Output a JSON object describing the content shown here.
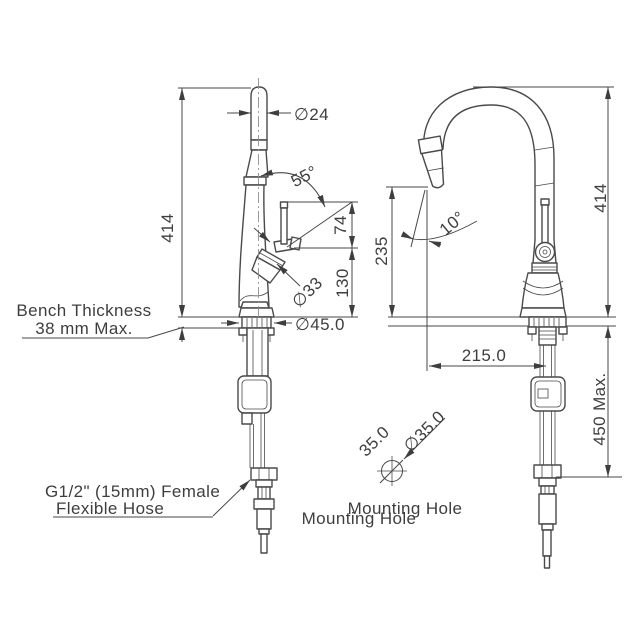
{
  "colors": {
    "ink": "#474747",
    "background": "#ffffff"
  },
  "views": {
    "left": {
      "overall_height": "414",
      "spout_diameter": "∅24",
      "handle_angle": "55°",
      "handle_height": "74",
      "spout_to_bench": "130",
      "cartridge_diameter": "∅33",
      "base_diameter": "∅45.0"
    },
    "right": {
      "overall_height": "414",
      "clearance_height": "235",
      "spray_head_angle": "10°",
      "spout_reach": "215.0",
      "hose_drop": "450 Max."
    }
  },
  "notes": {
    "bench_line1": "Bench Thickness",
    "bench_line2": "38 mm Max.",
    "hose_line1": "G1/2\" (15mm) Female",
    "hose_line2": "Flexible Hose"
  },
  "mounting_hole": {
    "width": "35.0",
    "diameter": "∅35.0",
    "label_rear": "Mounting Hole",
    "label_front": "Mounting Hole"
  }
}
